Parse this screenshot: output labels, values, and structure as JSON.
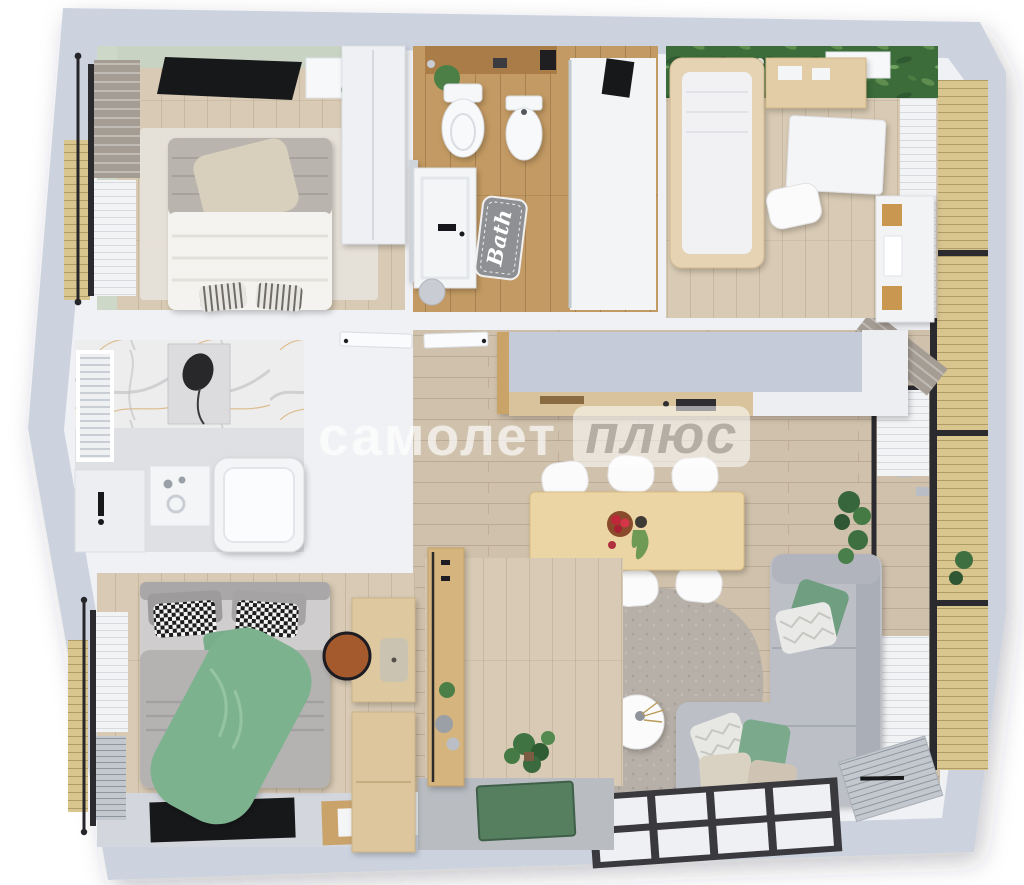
{
  "watermark": {
    "brand": "самолет",
    "plus": "плюс"
  },
  "bathroom": {
    "mat_label": "Bath"
  },
  "palette": {
    "outer_wall": "#ccd3df",
    "inner_wall": "#f0f1f4",
    "floor_wood": "#d8cab4",
    "floor_oak": "#c39a63",
    "floor_living": "#cfc1ab",
    "nursery_green_wall": "#3c6c3a",
    "sage_wall": "#c9d3c4",
    "sofa_gray": "#bcbfc6",
    "accent_green": "#7db28f",
    "deck_wood": "#d9c68e",
    "entry_floor": "#b9bdc2",
    "table_wood": "#ecd5a4",
    "window_frame": "#2b2b2f"
  }
}
